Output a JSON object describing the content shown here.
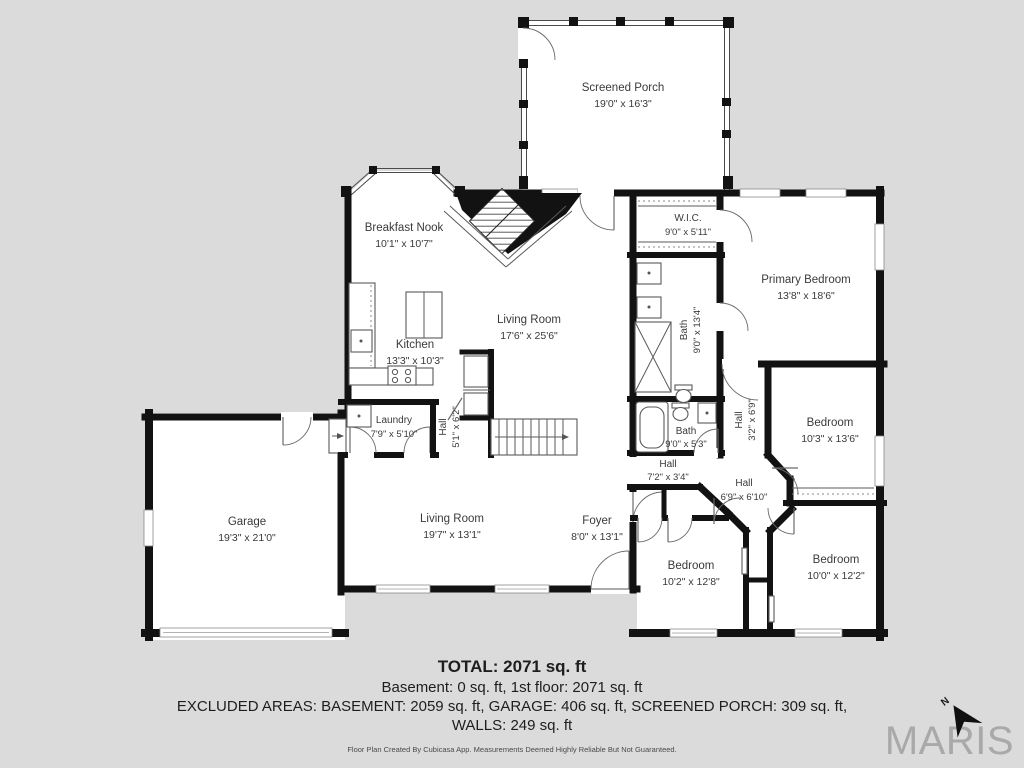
{
  "colors": {
    "background": "#dbdbdb",
    "floor": "#ffffff",
    "wall": "#121212",
    "label_text": "#3a3a3a",
    "brand_gray": "#a9a9a9"
  },
  "rooms": [
    {
      "name": "Screened Porch",
      "dims": "19'0\" x 16'3\""
    },
    {
      "name": "Breakfast Nook",
      "dims": "10'1\" x 10'7\""
    },
    {
      "name": "W.I.C.",
      "dims": "9'0\" x 5'11\""
    },
    {
      "name": "Primary Bedroom",
      "dims": "13'8\" x 18'6\""
    },
    {
      "name": "Living Room",
      "dims": "17'6\" x 25'6\""
    },
    {
      "name": "Kitchen",
      "dims": "13'3\" x 10'3\""
    },
    {
      "name": "Bath",
      "dims": "9'0\" x 13'4\""
    },
    {
      "name": "Laundry",
      "dims": "7'9\" x 5'10\""
    },
    {
      "name": "Hall",
      "dims": "5'1\" x 6'2\""
    },
    {
      "name": "Bath",
      "dims": "9'0\" x 5'3\""
    },
    {
      "name": "Hall",
      "dims": "3'2\" x 6'9\""
    },
    {
      "name": "Bedroom",
      "dims": "10'3\" x 13'6\""
    },
    {
      "name": "Hall",
      "dims": "7'2\" x 3'4\""
    },
    {
      "name": "Hall",
      "dims": "6'9\" x 6'10\""
    },
    {
      "name": "Garage",
      "dims": "19'3\" x 21'0\""
    },
    {
      "name": "Living Room",
      "dims": "19'7\" x 13'1\""
    },
    {
      "name": "Foyer",
      "dims": "8'0\" x 13'1\""
    },
    {
      "name": "Bedroom",
      "dims": "10'2\" x 12'8\""
    },
    {
      "name": "Bedroom",
      "dims": "10'0\" x 12'2\""
    }
  ],
  "footer": {
    "total": "TOTAL: 2071 sq. ft",
    "line2": "Basement: 0 sq. ft, 1st floor: 2071 sq. ft",
    "line3": "EXCLUDED AREAS: BASEMENT: 2059 sq. ft, GARAGE: 406 sq. ft, SCREENED PORCH: 309 sq. ft,",
    "line4": "WALLS: 249 sq. ft",
    "disclaimer": "Floor Plan Created By Cubicasa App. Measurements Deemed Highly Reliable But Not Guaranteed."
  },
  "logo": {
    "brand": "MARIS",
    "north": "N"
  }
}
